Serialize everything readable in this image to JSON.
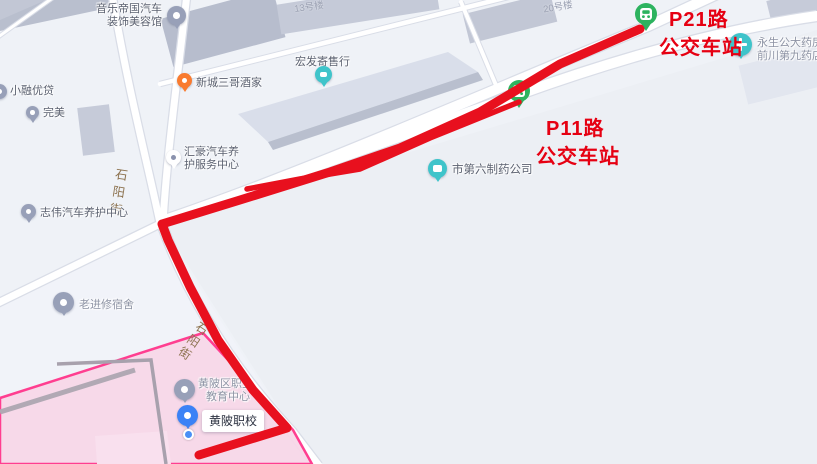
{
  "annotations": {
    "p21_station": {
      "line1": "P21路",
      "line2": "公交车站"
    },
    "p11_station": {
      "line1": "P11路",
      "line2": "公交车站"
    }
  },
  "streets": {
    "shiyang_upper": "石阳街",
    "shiyang_lower": "石阳街"
  },
  "building_labels": {
    "b13": "13号楼",
    "b20": "20号楼"
  },
  "pois": {
    "yinyue_diguo": {
      "line1": "音乐帝国汽车",
      "line2": "装饰美容馆"
    },
    "xiaorong_youdai": {
      "name": "小融优贷"
    },
    "wanmei": {
      "name": "完美"
    },
    "xincheng_sange": {
      "name": "新城三哥酒家"
    },
    "hongfa": {
      "name": "宏发寄售行"
    },
    "huihao": {
      "line1": "汇豪汽车养",
      "line2": "护服务中心"
    },
    "zhiwei": {
      "name": "志伟汽车养护中心"
    },
    "diliu_zhiyao": {
      "name": "市第六制药公司"
    },
    "yongsheng_yaofang": {
      "line1": "永生公大药房",
      "line2": "前川第九药店"
    },
    "lao_jinxiu": {
      "name": "老进修宿舍"
    },
    "huangpi_edu": {
      "line1": "黄陂区职业",
      "line2": "教育中心"
    },
    "huangpi_school": {
      "name": "黄陂职校"
    }
  },
  "colors": {
    "route_red": "#e60012",
    "campus_pink_fill": "#f7d6e7",
    "campus_pink_border": "#ff3e90",
    "bus_pin_green": "#2db35f",
    "poi_teal": "#3fc4ca",
    "school_pin_blue": "#3b82f6",
    "restaurant_orange": "#f97b2f",
    "street_label_brown": "#8d7350"
  }
}
